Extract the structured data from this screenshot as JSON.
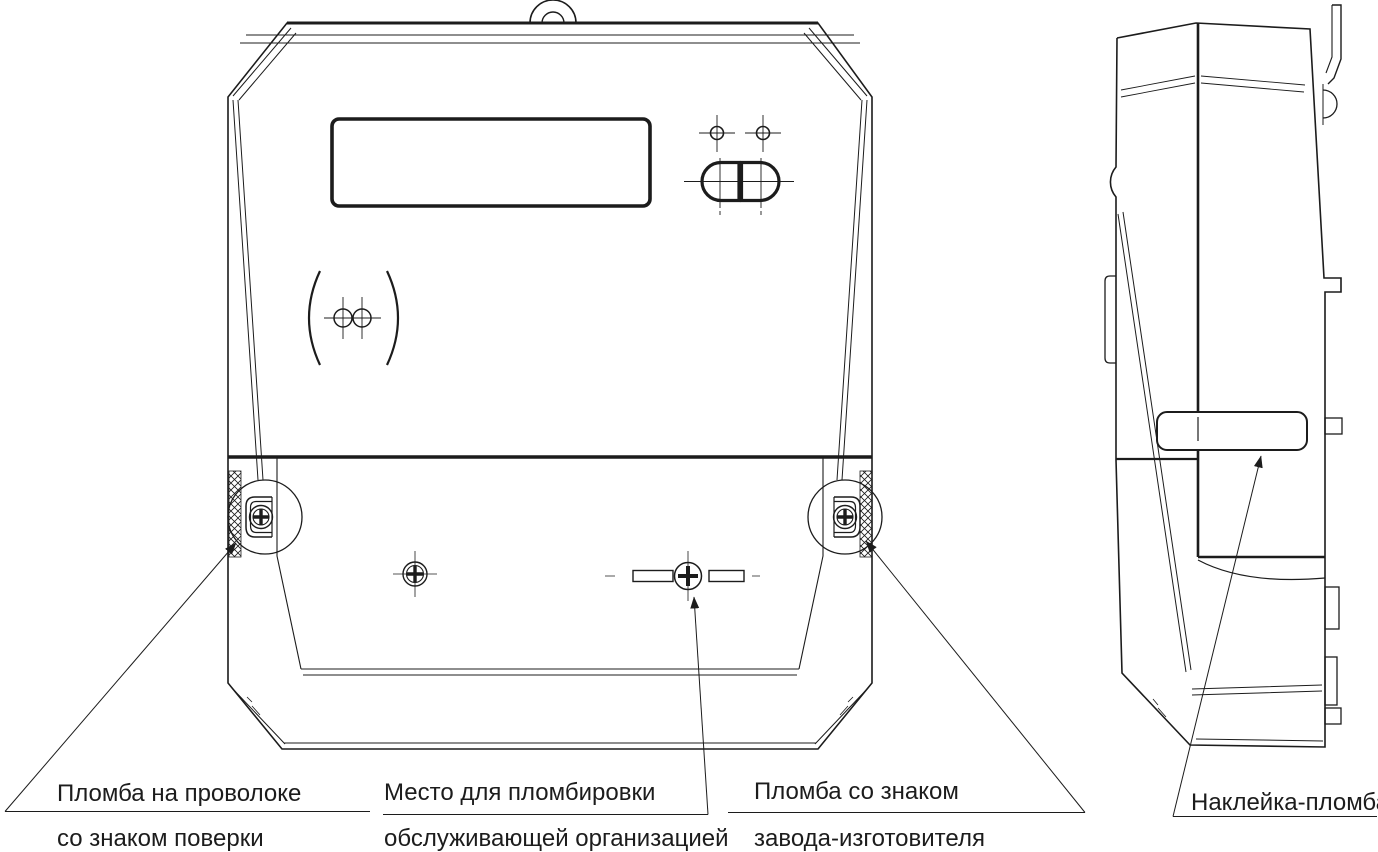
{
  "diagram": {
    "labels": {
      "verification_seal": {
        "line1": "Пломба на проволоке",
        "line2": "со знаком поверки"
      },
      "service_org_seal": {
        "line1": "Место для пломбировки",
        "line2": "обслуживающей организацией"
      },
      "factory_seal": {
        "line1": "Пломба со знаком",
        "line2": "завода-изготовителя"
      },
      "sticker_seal": {
        "text": "Наклейка-пломба"
      }
    },
    "colors": {
      "line": "#1c1c1c",
      "background": "#ffffff"
    }
  }
}
